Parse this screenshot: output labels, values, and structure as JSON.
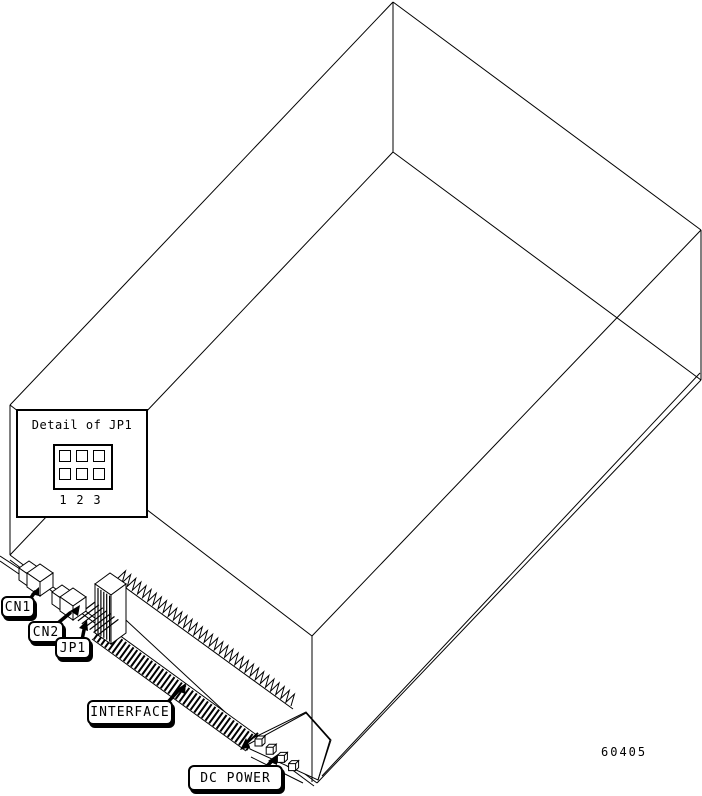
{
  "figure": {
    "type": "hardware-connector-diagram",
    "figure_number": "60405",
    "detail_inset": {
      "title": "Detail of JP1",
      "pin_labels": [
        "1",
        "2",
        "3"
      ],
      "pin_rows": 2,
      "pin_cols": 3
    },
    "callouts": [
      {
        "label": "CN1"
      },
      {
        "label": "CN2"
      },
      {
        "label": "JP1"
      },
      {
        "label": "INTERFACE"
      },
      {
        "label": "DC POWER"
      }
    ],
    "colors": {
      "line": "#000000",
      "background": "#ffffff"
    }
  }
}
